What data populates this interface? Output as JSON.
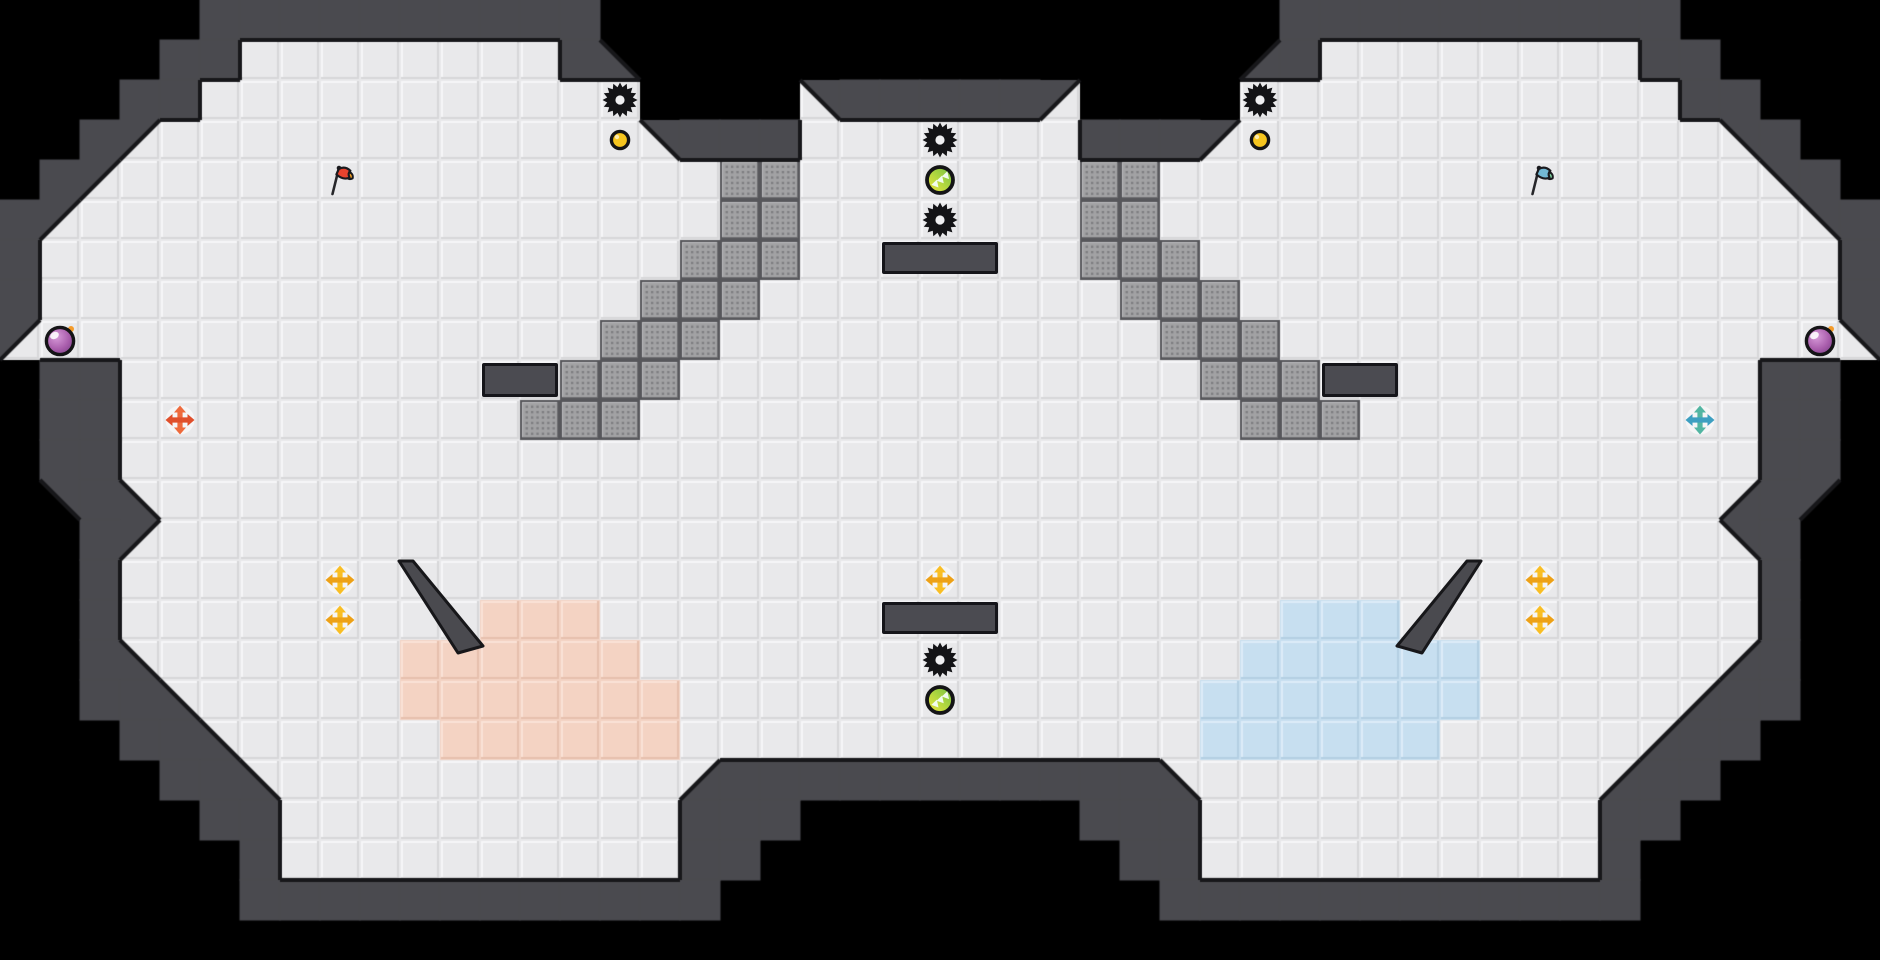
{
  "map": {
    "tile_size": 40,
    "cols": 47,
    "rows": 24,
    "grid": [
      "     ##########                 ##########     ",
      "    ##........#3               4#........##    ",
      "   ##...........    2#####1    ...........##   ",
      "  #1............2###.......###1............2#  ",
      " #1...............TT.......TT...............2# ",
      "#1................TT.......TT................2#",
      "#................TTT.......TTT................#",
      "#...............TTT.........TTT...............#",
      "1..............TTT...........TTT..............2",
      " ##...........TTT.............TTT...........## ",
      " ##..........TTT...............TTT..........## ",
      " ##.........................................## ",
      " 2#3.......................................4#1 ",
      "  #1.......................................2#  ",
      "  #.........................................#  ",
      "  #.........PPP.................BBB.........#  ",
      "  #3......PPPPPP...............BBBBBB......4#  ",
      "  ##3.....PPPPPPP.............BBBBBBB.....4##  ",
      "   ##3.....PPPPPP.............BBBBBB.....4##   ",
      "    ##3..........4###########3..........4##    ",
      "     ##..........###       ###..........##     ",
      "      #..........##         ##..........#      ",
      "      ############           ############      ",
      "                                               "
    ],
    "legend": {
      " ": "outside",
      "#": "wall",
      ".": "floor",
      "T": "textured-block",
      "P": "pink-team-zone",
      "B": "blue-team-zone",
      "1": "wall-wedge-nw",
      "2": "wall-wedge-ne",
      "3": "wall-wedge-sw",
      "4": "wall-wedge-se"
    },
    "wedge_black": [
      [
        15,
        1
      ],
      [
        31,
        1
      ],
      [
        1,
        12
      ],
      [
        45,
        12
      ]
    ]
  },
  "palette": {
    "outside": "#000000",
    "wall": "#4a4a4f",
    "wall_outline": "#17171a",
    "floor": "#e9e9eb",
    "floor_hl": "#f6f6f8",
    "floor_sh": "#d7d7d9",
    "pink": "#f4d3c3",
    "pink_hl": "#fae2d6",
    "pink_sh": "#e6c0ae",
    "blue": "#c7dff0",
    "blue_hl": "#ddecf8",
    "blue_sh": "#b3cfe3",
    "tex_base": "#a2a2a4",
    "tex_hl": "#bdbdbf",
    "tex_sh": "#6f6f72",
    "tex_border": "#57575b",
    "tex_dot": "rgba(40,40,46,0.30)",
    "spike": "#131316",
    "spike_hole": "#efeff1",
    "boost_ring": "#141416",
    "boost_grad": [
      "#6fbf44",
      "#b7d93f",
      "#f2e23b"
    ],
    "boost_chevron": "#f2fbee",
    "button_fill": "#f6c51f",
    "button_ring": "#141416",
    "bomb_grad": [
      "#d79ad9",
      "#a85cab",
      "#6f3c7e"
    ],
    "bomb_ring": "#141416",
    "bomb_spark": "#f49b2a",
    "flag_red": "#e8432e",
    "flag_red_tip": "#f6a324",
    "flag_blue": "#72b8d4",
    "flag_blue_tip": "#7fd4a0",
    "flag_outline": "#1a1a1e",
    "flag_pole": "#26262a",
    "arrows_orange": [
      "#ee6a3c",
      "#e04f2b"
    ],
    "arrows_teal": [
      "#52b5a2",
      "#3d9fc1"
    ],
    "arrows_yellow": [
      "#f9be24",
      "#eda117"
    ],
    "arrows_backdrop": "rgba(255,255,255,0.55)"
  },
  "objects": [
    {
      "name": "spike-icon",
      "type": "spike",
      "col": 15,
      "row": 2
    },
    {
      "name": "spike-icon",
      "type": "spike",
      "col": 31,
      "row": 2
    },
    {
      "name": "spike-icon",
      "type": "spike",
      "col": 23,
      "row": 3
    },
    {
      "name": "spike-icon",
      "type": "spike",
      "col": 23,
      "row": 5
    },
    {
      "name": "spike-icon",
      "type": "spike",
      "col": 23,
      "row": 16
    },
    {
      "name": "boost-pad-icon",
      "type": "boost",
      "col": 23,
      "row": 4
    },
    {
      "name": "boost-pad-icon",
      "type": "boost",
      "col": 23,
      "row": 17
    },
    {
      "name": "button-icon",
      "type": "button",
      "col": 15,
      "row": 3
    },
    {
      "name": "button-icon",
      "type": "button",
      "col": 31,
      "row": 3
    },
    {
      "name": "bomb-icon",
      "type": "bomb",
      "col": 1,
      "row": 8
    },
    {
      "name": "bomb-icon",
      "type": "bomb",
      "col": 45,
      "row": 8
    },
    {
      "name": "red-flag-icon",
      "type": "flag",
      "variant": "red",
      "col": 8,
      "row": 4
    },
    {
      "name": "blue-flag-icon",
      "type": "flag",
      "variant": "blue",
      "col": 38,
      "row": 4
    },
    {
      "name": "orange-arrows-icon",
      "type": "arrows",
      "variant": "orange",
      "col": 4,
      "row": 10
    },
    {
      "name": "teal-arrows-icon",
      "type": "arrows",
      "variant": "teal",
      "col": 42,
      "row": 10
    },
    {
      "name": "yellow-arrows-icon",
      "type": "arrows",
      "variant": "yellow",
      "col": 8,
      "row": 14
    },
    {
      "name": "yellow-arrows-icon",
      "type": "arrows",
      "variant": "yellow",
      "col": 8,
      "row": 15
    },
    {
      "name": "yellow-arrows-icon",
      "type": "arrows",
      "variant": "yellow",
      "col": 23,
      "row": 14
    },
    {
      "name": "yellow-arrows-icon",
      "type": "arrows",
      "variant": "yellow",
      "col": 38,
      "row": 14
    },
    {
      "name": "yellow-arrows-icon",
      "type": "arrows",
      "variant": "yellow",
      "col": 38,
      "row": 15
    }
  ],
  "bars": [
    {
      "x": 482,
      "y": 363,
      "w": 76,
      "h": 34
    },
    {
      "x": 1322,
      "y": 363,
      "w": 76,
      "h": 34
    },
    {
      "x": 882,
      "y": 242,
      "w": 116,
      "h": 32
    },
    {
      "x": 882,
      "y": 602,
      "w": 116,
      "h": 32
    }
  ],
  "slivers": [
    {
      "points": [
        [
          399,
          561
        ],
        [
          413,
          561
        ],
        [
          483,
          646
        ],
        [
          458,
          653
        ]
      ]
    },
    {
      "points": [
        [
          1481,
          561
        ],
        [
          1467,
          561
        ],
        [
          1397,
          646
        ],
        [
          1422,
          653
        ]
      ]
    }
  ]
}
